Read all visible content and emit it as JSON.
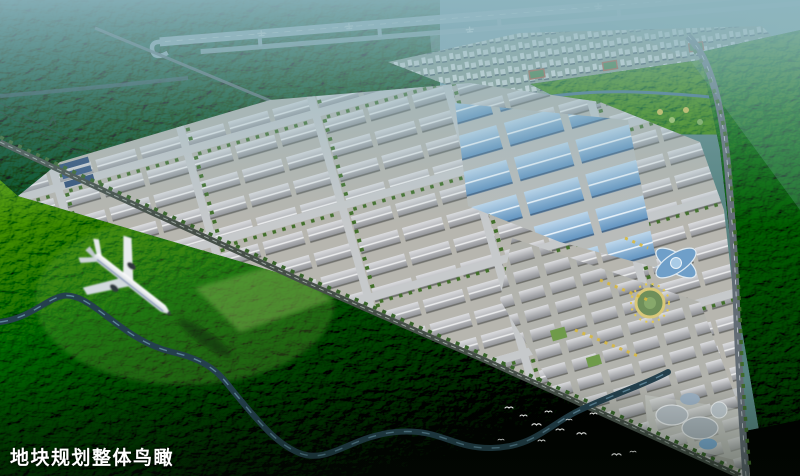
{
  "caption": {
    "text": "地块规划整体鸟瞰"
  },
  "palette": {
    "haze": "#8fb6c1",
    "forest_bright": "#5d9a33",
    "forest_mid": "#2e5c1b",
    "forest_dark": "#122b0b",
    "park_ground": "#b7b6af",
    "roof_gray": "#9b9ca1",
    "roof_blue": "#6f9fc9",
    "water": "#24404d",
    "road": "#626c75",
    "runway": "#a7bec9",
    "airplane_body": "#f2f5f6",
    "bird": "#ffffff",
    "caption_color": "#ffffff"
  }
}
